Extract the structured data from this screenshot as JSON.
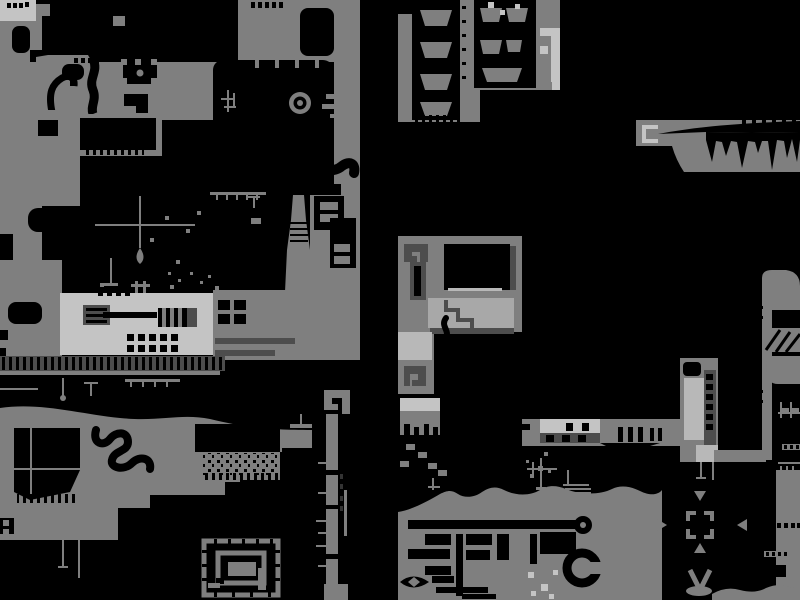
{
  "screen": {
    "type": "game-world-map",
    "description": "Monochrome side-scroller world map: gray terrain masses on black background"
  },
  "palette": {
    "background": "#000000",
    "terrain": "#7f7f7f",
    "terrain_light": "#c4c4c4",
    "terrain_mid": "#a8a8a8",
    "accent_light": "#b8b8b8",
    "detail_dark": "#4d4d4d",
    "detail_darker": "#333333"
  },
  "features": [
    "ring-emblem",
    "spiral-maze",
    "arrow-shrine",
    "v-glyph",
    "meander-glyph",
    "factory-slab",
    "train-structure",
    "ladder-tower",
    "spike-cavern",
    "rubble-patch",
    "s-curve-channel",
    "boot-void",
    "trapezoid-rooms"
  ]
}
